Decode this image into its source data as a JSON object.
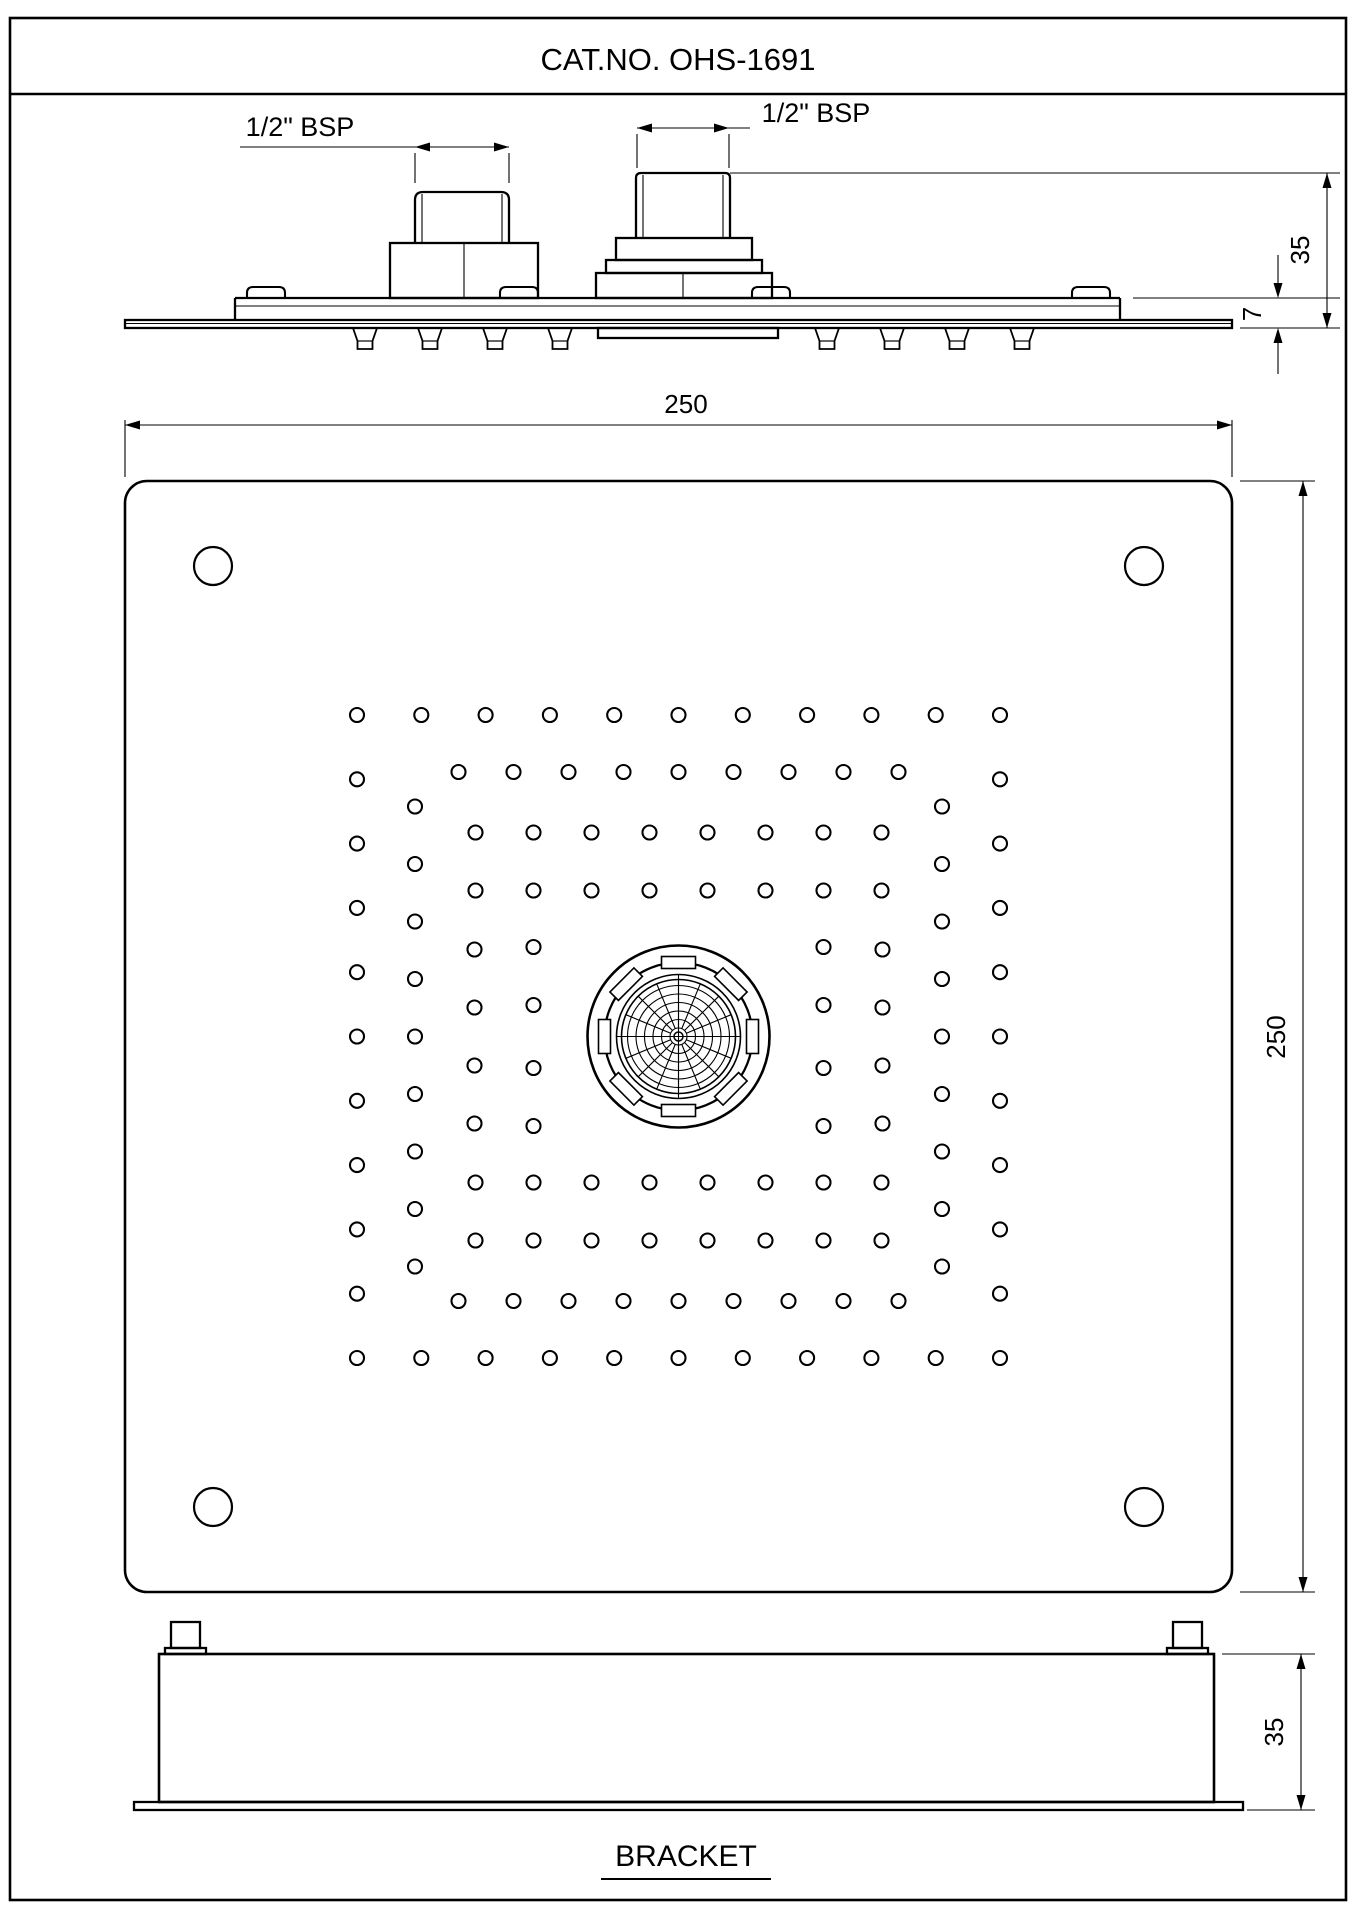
{
  "title_block": {
    "title": "CAT.NO. OHS-1691"
  },
  "side_view": {
    "left_inlet_label": "1/2\" BSP",
    "right_inlet_label": "1/2\" BSP",
    "dim_total_height": "35",
    "dim_plate_height": "7",
    "spray_nozzle_xs": [
      365,
      430,
      495,
      560,
      827,
      892,
      957,
      1022
    ],
    "clip_bump_xs": [
      247,
      500,
      752,
      1072
    ]
  },
  "plate_view": {
    "dim_width": "250",
    "dim_height": "250",
    "corner_hole_radius": 19,
    "corner_holes": [
      [
        213,
        566
      ],
      [
        1144,
        566
      ],
      [
        213,
        1507
      ],
      [
        1144,
        1507
      ]
    ],
    "pattern": {
      "center_x": 678.5,
      "center_y": 1036.5,
      "hole_radius": 7,
      "rings": [
        {
          "off_y": 321.5,
          "off_x": 321.5,
          "row_dxs": [
            -321.5,
            -257.2,
            -192.9,
            -128.6,
            -64.3,
            0,
            64.3,
            128.6,
            192.9,
            257.2,
            321.5
          ],
          "col_dys": [
            -257.2,
            -192.9,
            -128.6,
            -64.3,
            0,
            64.3,
            128.6,
            192.9,
            257.2
          ]
        },
        {
          "off_y": 264.5,
          "off_x": 263.5,
          "row_dxs": [
            -220,
            -165,
            -110,
            -55,
            0,
            55,
            110,
            165,
            220
          ],
          "col_dys": [
            -230,
            -172.5,
            -115,
            -57.5,
            0,
            57.5,
            115,
            172.5,
            230
          ]
        },
        {
          "off_y": 204,
          "off_x": 204,
          "row_dxs": [
            -203,
            -145,
            -87,
            -29,
            29,
            87,
            145,
            203
          ],
          "col_dys": [
            -87,
            -29,
            29,
            87
          ]
        },
        {
          "off_y": 146,
          "off_x": 145,
          "row_dxs": [
            -203,
            -145,
            -87,
            -29,
            29,
            87,
            145,
            203
          ],
          "col_dys": [
            -89.5,
            -31.5,
            31.5,
            89.5
          ]
        }
      ]
    },
    "nozzle": {
      "cx": 678.5,
      "cy": 1036.5,
      "outer_r": 91,
      "tab_ring_r": 74,
      "inner_r": 62,
      "mesh_r": 57,
      "mesh_ring_radii": [
        8.5,
        17,
        25.5,
        34,
        42.5,
        51
      ],
      "radial_count": 16,
      "tab_count": 8,
      "tab_w": 34,
      "tab_h": 12,
      "center_r": 4.5
    }
  },
  "bracket_view": {
    "caption": "BRACKET",
    "dim_height": "35"
  },
  "colors": {
    "line": "#000000",
    "background": "#ffffff"
  }
}
